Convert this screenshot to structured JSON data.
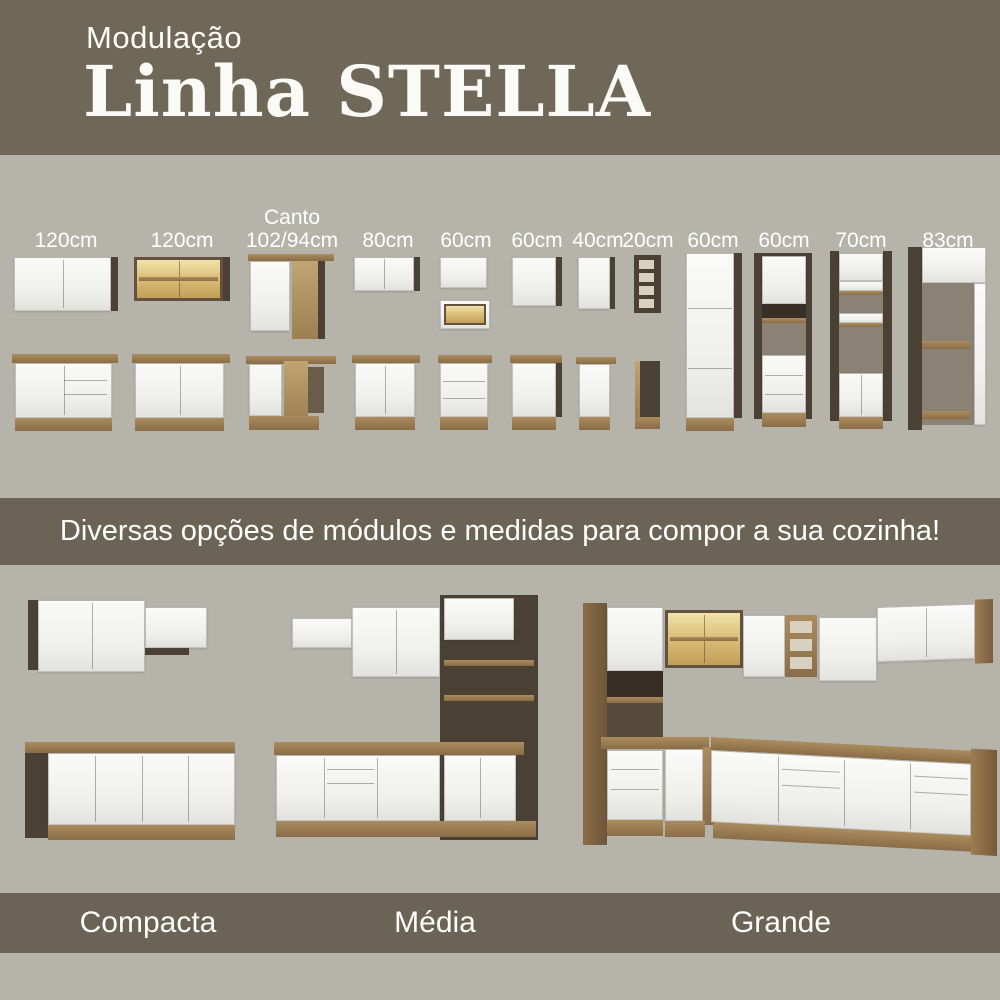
{
  "header": {
    "kicker": "Modulação",
    "title": "Linha STELLA"
  },
  "modules": {
    "items": [
      {
        "label": "120cm",
        "kind": "wall-cabinet-2-door + base-cabinet"
      },
      {
        "label": "120cm",
        "kind": "glass-wall-cabinet + base-cabinet"
      },
      {
        "label_top": "Canto",
        "label": "102/94cm",
        "kind": "corner-wall + corner-base"
      },
      {
        "label": "80cm",
        "kind": "wall-cabinet + base-cabinet"
      },
      {
        "label": "60cm",
        "kind": "wall-cabinet + open-niche + drawer-base"
      },
      {
        "label": "60cm",
        "kind": "wall-cabinet + base-cabinet"
      },
      {
        "label": "40cm",
        "kind": "wall-cabinet + base-cabinet"
      },
      {
        "label": "20cm",
        "kind": "open-shelf-column + slim-base"
      },
      {
        "label": "60cm",
        "kind": "tall-pantry-cabinet"
      },
      {
        "label": "60cm",
        "kind": "tall-oven-tower"
      },
      {
        "label": "70cm",
        "kind": "tall-open-shelf-cabinet"
      },
      {
        "label": "83cm",
        "kind": "tall-open-frame-cabinet"
      }
    ]
  },
  "banner": {
    "text": "Diversas opções de módulos e medidas para compor a sua cozinha!"
  },
  "kitchens": {
    "items": [
      {
        "name": "Compacta"
      },
      {
        "name": "Média"
      },
      {
        "name": "Grande"
      }
    ]
  },
  "colors": {
    "header_band": "#6f6859",
    "band": "#6b6456",
    "background": "#b6b3ab",
    "wood": "#9c7d52",
    "dark_panel": "#4b4034",
    "front_white": "#f6f6f4",
    "glass_amber": "#dcc07a"
  }
}
